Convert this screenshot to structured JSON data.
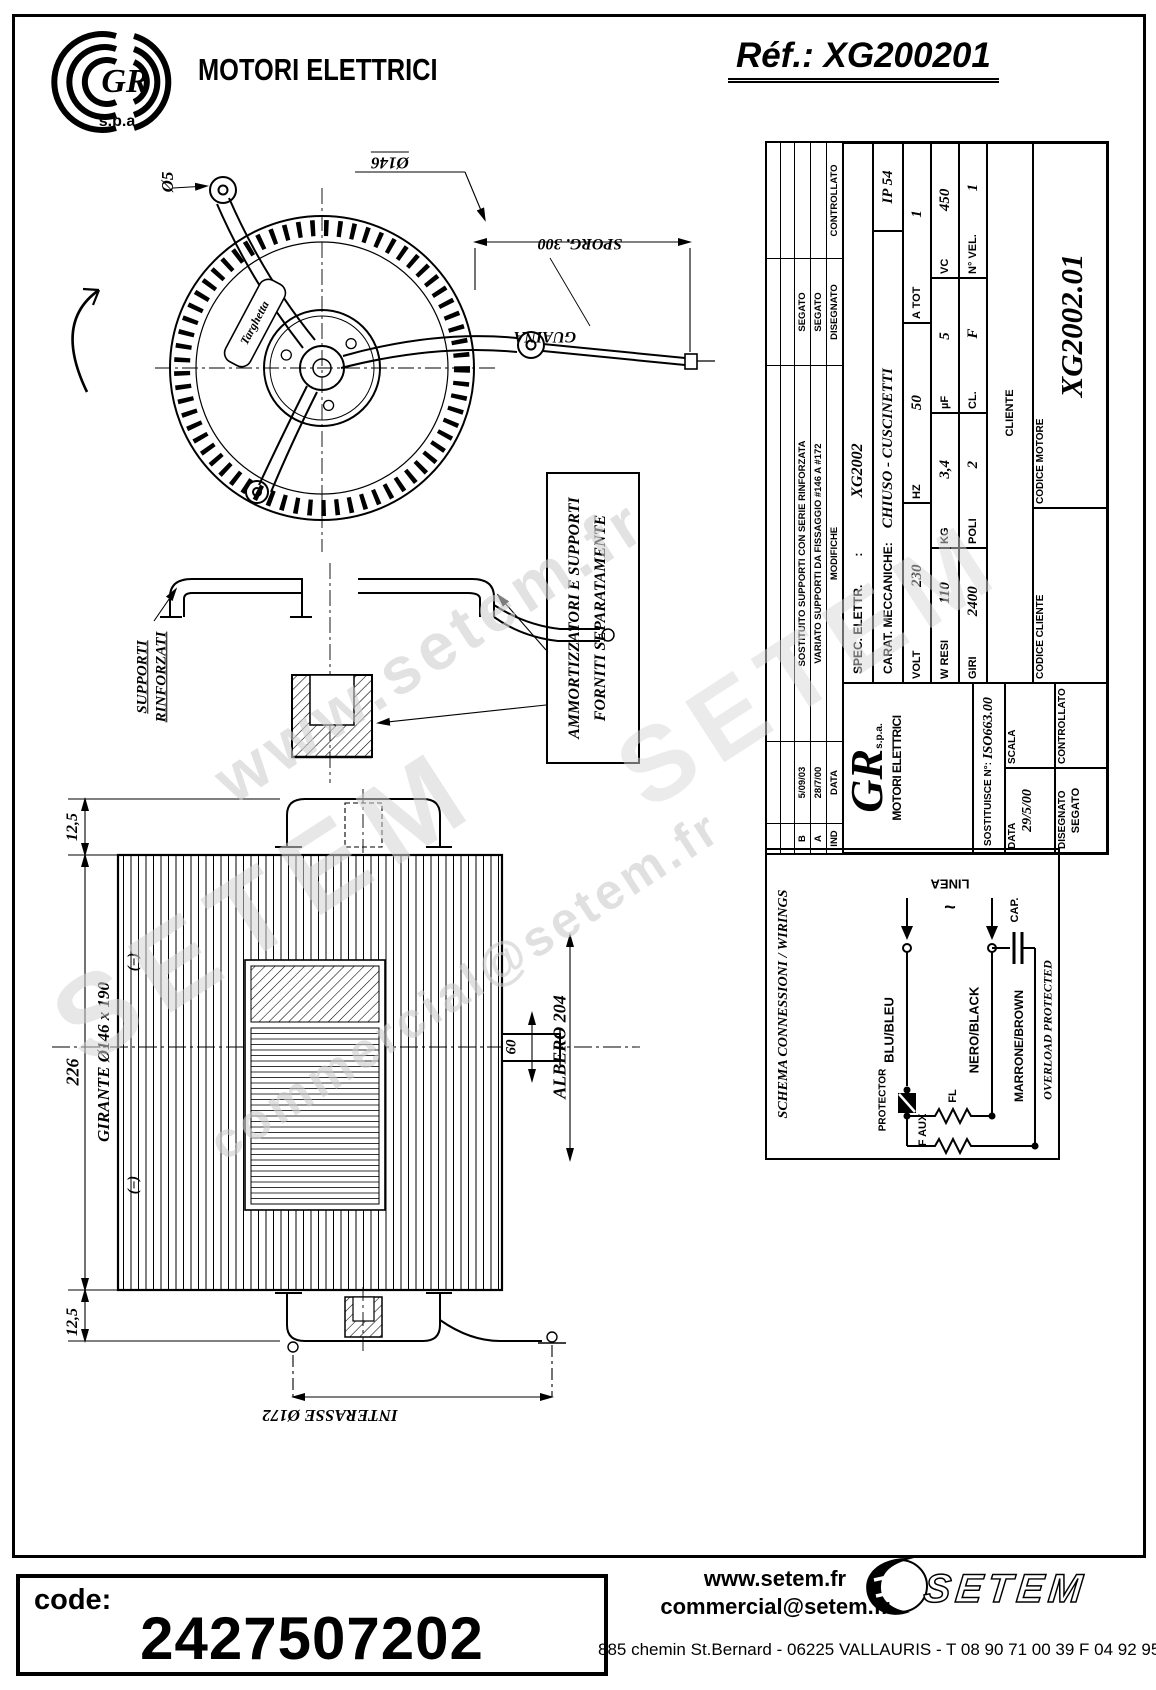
{
  "header": {
    "logo_gr": "GR",
    "logo_spa": "s.p.a",
    "brand": "MOTORI ELETTRICI",
    "ref": "Réf.: XG200201"
  },
  "fan_view": {
    "dia_small": "Ø5",
    "dia_ring": "Ø146",
    "sporg": "SPORG. 300",
    "guaina": "GUAINA",
    "targhetta": "Targhetta"
  },
  "supports_view": {
    "label_line1": "SUPPORTI",
    "label_line2": "RINFORZATI",
    "note_line1": "AMMORTIZZATORI E SUPPORTI",
    "note_line2": "FORNITI SEPARATAMENTE"
  },
  "side_view": {
    "offset_top": "12,5",
    "height_total": "226",
    "offset_bottom": "12,5",
    "girante": "GIRANTE  Ø146 x 190",
    "eq_top": "(=)",
    "eq_bottom": "(=)",
    "albero": "ALBERO 204",
    "shaft_dim": "60",
    "interasse": "INTERASSE Ø172"
  },
  "title_block": {
    "revisions": [
      {
        "ind": "B",
        "date": "5/09/03",
        "modifiche": "SOSTITUITO SUPPORTI CON SERIE RINFORZATA",
        "disegnato": "SEGATO",
        "controllato": ""
      },
      {
        "ind": "A",
        "date": "28/7/00",
        "modifiche": "VARIATO SUPPORTI DA FISSAGGIO #146 A #172",
        "disegnato": "SEGATO",
        "controllato": ""
      }
    ],
    "headers": {
      "ind": "IND",
      "date": "DATA",
      "modifiche": "MODIFICHE",
      "disegnato": "DISEGNATO",
      "controllato": "CONTROLLATO"
    },
    "spec_label": "SPEC. ELETTR.",
    "spec_sep": ":",
    "spec_value": "XG2002",
    "carat_label": "CARAT. MECCANICHE:",
    "carat_value": "CHIUSO - CUSCINETTI",
    "ip": "IP 54",
    "volt": {
      "label": "VOLT",
      "value": "230"
    },
    "hz": {
      "label": "HZ",
      "value": "50"
    },
    "atot": {
      "label": "A TOT",
      "value": "1"
    },
    "wresi": {
      "label": "W RESI",
      "value": "110"
    },
    "kg": {
      "label": "KG",
      "value": "3,4"
    },
    "uf": {
      "label": "µF",
      "value": "5"
    },
    "vc": {
      "label": "VC",
      "value": "450"
    },
    "giri": {
      "label": "GIRI",
      "value": "2400"
    },
    "poli": {
      "label": "POLI",
      "value": "2"
    },
    "cl": {
      "label": "CL.",
      "value": "F"
    },
    "nvel": {
      "label": "N° VEL.",
      "value": "1"
    },
    "gr_logo": "GR",
    "gr_spa": "s.p.a.",
    "gr_brand": "MOTORI ELETTRICI",
    "sostituisce_label": "SOSTITUISCE N°:",
    "sostituisce_value": "ISO663.00",
    "data_label": "DATA",
    "data_value": "29/5/00",
    "scala_label": "SCALA",
    "disegnato_label": "DISEGNATO",
    "disegnato_value": "SEGATO",
    "controllato_label": "CONTROLLATO",
    "cliente_label": "CLIENTE",
    "codice_cliente_label": "CODICE CLIENTE",
    "codice_motore_label": "CODICE MOTORE",
    "codice_motore_value": "XG2002.01"
  },
  "schematic": {
    "title": "SCHEMA CONNESSIONI / WIRINGS",
    "linea": "LINEA",
    "ac": "~",
    "blu": "BLU/BLEU",
    "nero": "NERO/BLACK",
    "protector": "PROTECTOR",
    "fl": "FL",
    "faux": "F AUX",
    "marrone": "MARRONE/BROWN",
    "cap": "CAP.",
    "overload": "OVERLOAD PROTECTED"
  },
  "watermarks": {
    "w1": "www.setem.fr",
    "w2": "SETEM",
    "w3": "commercial@setem.fr",
    "w4": "SETEM"
  },
  "footer": {
    "code_label": "code:",
    "code_value": "2427507202",
    "site": "www.setem.fr",
    "email": "commercial@setem.fr",
    "address": "885 chemin St.Bernard  -  06225 VALLAURIS  -  T 08 90 71 00 39   F 04 92 95 19 39",
    "logo": "SETEM"
  },
  "colors": {
    "ink": "#000000",
    "paper": "#ffffff",
    "watermark": "#cccccc"
  }
}
